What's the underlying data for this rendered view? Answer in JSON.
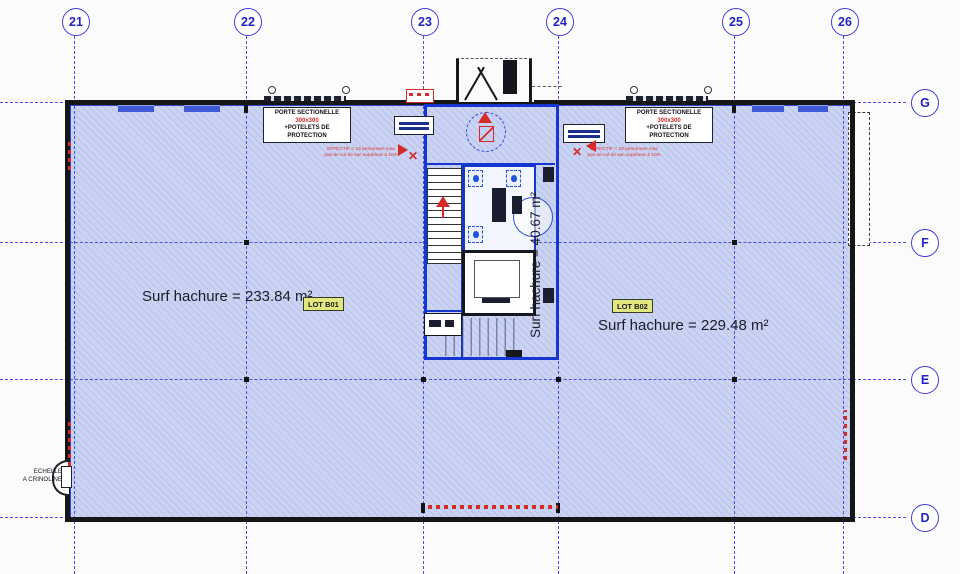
{
  "plan": {
    "grid": {
      "columns": [
        "21",
        "22",
        "23",
        "24",
        "25",
        "26"
      ],
      "rows": [
        "G",
        "F",
        "E",
        "D"
      ]
    },
    "lots": {
      "b01": {
        "tag": "LOT B01",
        "surface": "Surf hachure = 233.84 m²"
      },
      "b02": {
        "tag": "LOT B02",
        "surface": "Surf hachure = 229.48 m²"
      },
      "core": {
        "surface": "Surf hachure = 40.67 m²"
      }
    },
    "notes": {
      "porte": {
        "name": "PORTE SECTIONELLE",
        "size": "300x300",
        "extra": "+POTELETS DE PROTECTION"
      },
      "effectif": {
        "line1": "EFFECTIF < 19 personnes max",
        "line2": "pas de cul de sac supérieur à 10m"
      },
      "echelle": {
        "line1": "ECHELLE",
        "line2": "A CRINOLINE"
      }
    },
    "colors": {
      "grid_line": "#4d4de0",
      "hatch_fill": "#cbd3f2",
      "wall": "#161616",
      "core_wall": "#1437d0",
      "accent_red": "#d42a2a",
      "lot_tag_bg": "#e3e77f"
    }
  }
}
